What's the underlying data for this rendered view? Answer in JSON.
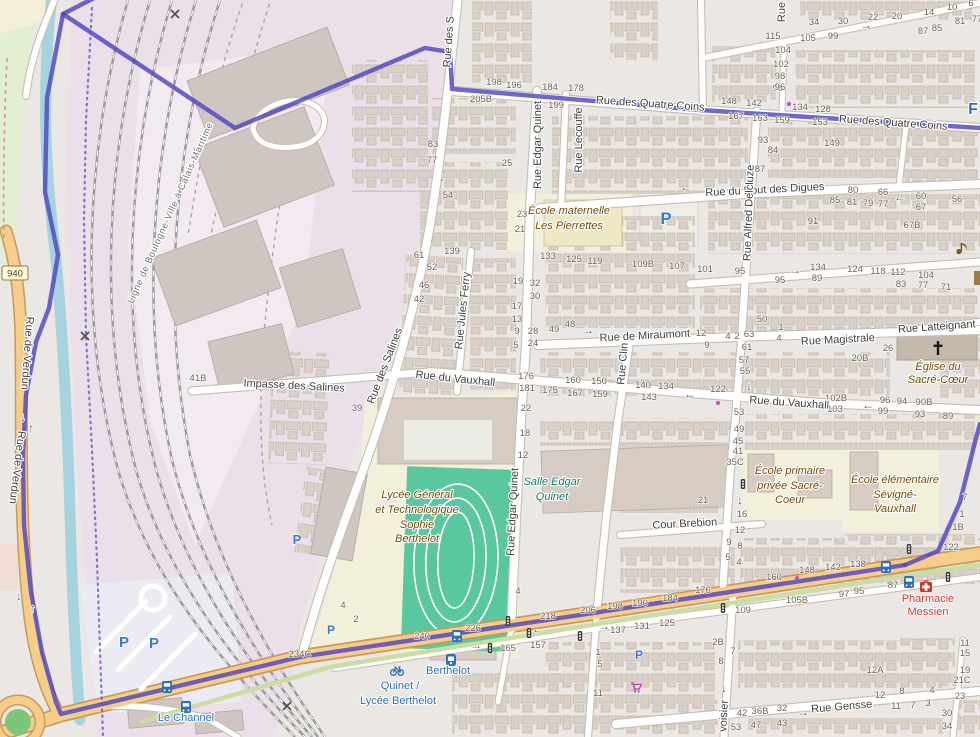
{
  "palette": {
    "boundary": "#4E46C2",
    "primary_road": "#F7CD8C",
    "railway_landuse": "#EBDFE9",
    "school": "#F2EFDA",
    "pitch_green": "#5BC79E",
    "canal": "#A6D3DD",
    "poi_brown": "#734A08",
    "leisure_teal": "#117a68",
    "health_red": "#C9362C",
    "transport_blue": "#2E6FB5",
    "parking_blue": "#3A79CA"
  },
  "badges": {
    "d940": "940"
  },
  "arrow_glyphs": {
    "left": "←",
    "right": "→",
    "up": "↑",
    "down": "↓"
  },
  "street_labels": [
    {
      "t": "Rue des Quatre Coins",
      "x": 650,
      "y": 107,
      "rot": 4
    },
    {
      "t": "Rue des Quatre Coins",
      "x": 893,
      "y": 126,
      "rot": 4
    },
    {
      "t": "Rue du Bout des Digues",
      "x": 765,
      "y": 193,
      "rot": -3
    },
    {
      "t": "Rue de Miraumont",
      "x": 645,
      "y": 339,
      "rot": -3
    },
    {
      "t": "Rue Magistrale",
      "x": 838,
      "y": 343,
      "rot": -3
    },
    {
      "t": "Rue Latteignant",
      "x": 937,
      "y": 330,
      "rot": -4
    },
    {
      "t": "Impasse des Salines",
      "x": 294,
      "y": 389,
      "rot": 3
    },
    {
      "t": "Rue du Vauxhall",
      "x": 455,
      "y": 382,
      "rot": 6
    },
    {
      "t": "Rue du Vauxhall",
      "x": 789,
      "y": 406,
      "rot": 4
    },
    {
      "t": "Cour Brebion",
      "x": 685,
      "y": 527,
      "rot": -3
    },
    {
      "t": "Rue Gensse",
      "x": 842,
      "y": 710,
      "rot": -5
    },
    {
      "t": "Rue Edgar Quinet",
      "x": 541,
      "y": 145,
      "rot": -90
    },
    {
      "t": "Rue Edgar Quinet",
      "x": 516,
      "y": 512,
      "rot": -87
    },
    {
      "t": "Rue Lecouffe",
      "x": 582,
      "y": 140,
      "rot": -90
    },
    {
      "t": "Rue Jules Ferry",
      "x": 466,
      "y": 311,
      "rot": -84
    },
    {
      "t": "Rue des Salines",
      "x": 388,
      "y": 367,
      "rot": -69
    },
    {
      "t": "Rue des S",
      "x": 452,
      "y": 42,
      "rot": -86
    },
    {
      "t": "Rue Clin",
      "x": 626,
      "y": 364,
      "rot": -85
    },
    {
      "t": "Rue Alfred Delcluze",
      "x": 752,
      "y": 213,
      "rot": -88
    },
    {
      "t": "Rue de Verdun",
      "x": 24,
      "y": 353,
      "rot": 94
    },
    {
      "t": "Rue de Verdun",
      "x": 14,
      "y": 467,
      "rot": 97
    },
    {
      "t": "voisier",
      "x": 727,
      "y": 716,
      "rot": -87
    },
    {
      "t": "Rue",
      "x": 785,
      "y": 12,
      "rot": -90
    },
    {
      "t": "Ligne de Boulogne-Ville à Calais-Maritime",
      "x": 173,
      "y": 214,
      "rot": -66,
      "cls": "rail"
    }
  ],
  "poi_labels": [
    {
      "t": "École maternelle",
      "x": 569,
      "y": 214
    },
    {
      "t": "Les Pierrettes",
      "x": 569,
      "y": 229
    },
    {
      "t": "Lycée Général",
      "x": 417,
      "y": 498
    },
    {
      "t": "et Technologique",
      "x": 417,
      "y": 513
    },
    {
      "t": "Sophie",
      "x": 417,
      "y": 528
    },
    {
      "t": "Berthelot",
      "x": 417,
      "y": 542
    },
    {
      "t": "Salle Edgar",
      "x": 552,
      "y": 485,
      "cls": "leisure"
    },
    {
      "t": "Quinet",
      "x": 552,
      "y": 500,
      "cls": "leisure"
    },
    {
      "t": "École primaire",
      "x": 790,
      "y": 474
    },
    {
      "t": "privée Sacré-",
      "x": 790,
      "y": 489
    },
    {
      "t": "Coeur",
      "x": 790,
      "y": 503
    },
    {
      "t": "École élémentaire",
      "x": 895,
      "y": 483
    },
    {
      "t": "Sévigné-",
      "x": 895,
      "y": 498
    },
    {
      "t": "Vauxhall",
      "x": 895,
      "y": 512
    },
    {
      "t": "Église du",
      "x": 938,
      "y": 370
    },
    {
      "t": "Sacré-Cœur",
      "x": 938,
      "y": 383
    },
    {
      "t": "Pharmacie",
      "x": 928,
      "y": 602,
      "cls": "health"
    },
    {
      "t": "Messien",
      "x": 928,
      "y": 615,
      "cls": "health"
    }
  ],
  "transport_labels": [
    {
      "t": "Berthelot",
      "x": 448,
      "y": 674
    },
    {
      "t": "Quinet /",
      "x": 400,
      "y": 689
    },
    {
      "t": "Lycée Berthelot",
      "x": 398,
      "y": 704
    },
    {
      "t": "Le Channel",
      "x": 186,
      "y": 721
    },
    {
      "t": "F",
      "x": 973,
      "y": 114,
      "cls": "big-blue"
    }
  ],
  "house_numbers": [
    {
      "t": "198",
      "x": 494,
      "y": 85
    },
    {
      "t": "196",
      "x": 514,
      "y": 88
    },
    {
      "t": "184",
      "x": 550,
      "y": 90
    },
    {
      "t": "178",
      "x": 576,
      "y": 91
    },
    {
      "t": "205B",
      "x": 481,
      "y": 102
    },
    {
      "t": "199",
      "x": 556,
      "y": 108
    },
    {
      "t": "96",
      "x": 778,
      "y": 91
    },
    {
      "t": "148",
      "x": 729,
      "y": 104
    },
    {
      "t": "142",
      "x": 754,
      "y": 106
    },
    {
      "t": "134",
      "x": 800,
      "y": 110
    },
    {
      "t": "128",
      "x": 823,
      "y": 112
    },
    {
      "t": "167",
      "x": 736,
      "y": 119
    },
    {
      "t": "163",
      "x": 760,
      "y": 121
    },
    {
      "t": "159",
      "x": 782,
      "y": 123
    },
    {
      "t": "153",
      "x": 820,
      "y": 125
    },
    {
      "t": "34",
      "x": 814,
      "y": 25
    },
    {
      "t": "30",
      "x": 843,
      "y": 24
    },
    {
      "t": "22",
      "x": 873,
      "y": 20
    },
    {
      "t": "20",
      "x": 897,
      "y": 19
    },
    {
      "t": "14",
      "x": 929,
      "y": 15
    },
    {
      "t": "10",
      "x": 952,
      "y": 10
    },
    {
      "t": "6",
      "x": 971,
      "y": 6
    },
    {
      "t": "115",
      "x": 773,
      "y": 39
    },
    {
      "t": "105",
      "x": 808,
      "y": 41
    },
    {
      "t": "99",
      "x": 833,
      "y": 39
    },
    {
      "t": "104",
      "x": 783,
      "y": 53
    },
    {
      "t": "102",
      "x": 781,
      "y": 67
    },
    {
      "t": "98",
      "x": 780,
      "y": 79
    },
    {
      "t": "96",
      "x": 780,
      "y": 90
    },
    {
      "t": "87",
      "x": 923,
      "y": 34
    },
    {
      "t": "85",
      "x": 937,
      "y": 31
    },
    {
      "t": "81",
      "x": 960,
      "y": 24
    },
    {
      "t": "77",
      "x": 977,
      "y": 22
    },
    {
      "t": "93",
      "x": 763,
      "y": 143
    },
    {
      "t": "84",
      "x": 773,
      "y": 153
    },
    {
      "t": "87",
      "x": 760,
      "y": 172
    },
    {
      "t": "149",
      "x": 832,
      "y": 146
    },
    {
      "t": "80",
      "x": 853,
      "y": 193
    },
    {
      "t": "66",
      "x": 883,
      "y": 195
    },
    {
      "t": "60",
      "x": 921,
      "y": 199
    },
    {
      "t": "56",
      "x": 957,
      "y": 202
    },
    {
      "t": "85",
      "x": 835,
      "y": 203
    },
    {
      "t": "81",
      "x": 852,
      "y": 205
    },
    {
      "t": "79",
      "x": 868,
      "y": 206
    },
    {
      "t": "77",
      "x": 883,
      "y": 207
    },
    {
      "t": "67",
      "x": 921,
      "y": 210
    },
    {
      "t": "91",
      "x": 813,
      "y": 224
    },
    {
      "t": "67B",
      "x": 912,
      "y": 228
    },
    {
      "t": "83",
      "x": 433,
      "y": 147
    },
    {
      "t": "77",
      "x": 432,
      "y": 163
    },
    {
      "t": "25",
      "x": 507,
      "y": 166
    },
    {
      "t": "54",
      "x": 448,
      "y": 198
    },
    {
      "t": "23",
      "x": 522,
      "y": 217
    },
    {
      "t": "21",
      "x": 520,
      "y": 232
    },
    {
      "t": "139",
      "x": 452,
      "y": 254
    },
    {
      "t": "61",
      "x": 419,
      "y": 258
    },
    {
      "t": "52",
      "x": 432,
      "y": 270
    },
    {
      "t": "46",
      "x": 424,
      "y": 288
    },
    {
      "t": "42",
      "x": 419,
      "y": 302
    },
    {
      "t": "19",
      "x": 518,
      "y": 284
    },
    {
      "t": "32",
      "x": 535,
      "y": 286
    },
    {
      "t": "30",
      "x": 535,
      "y": 299
    },
    {
      "t": "17",
      "x": 517,
      "y": 309
    },
    {
      "t": "13",
      "x": 517,
      "y": 322
    },
    {
      "t": "9",
      "x": 517,
      "y": 334
    },
    {
      "t": "5",
      "x": 516,
      "y": 348
    },
    {
      "t": "28",
      "x": 533,
      "y": 334
    },
    {
      "t": "24",
      "x": 533,
      "y": 346
    },
    {
      "t": "49",
      "x": 554,
      "y": 332
    },
    {
      "t": "48",
      "x": 570,
      "y": 327
    },
    {
      "t": "133",
      "x": 548,
      "y": 259
    },
    {
      "t": "125",
      "x": 574,
      "y": 262
    },
    {
      "t": "119",
      "x": 595,
      "y": 264
    },
    {
      "t": "109B",
      "x": 643,
      "y": 267
    },
    {
      "t": "107",
      "x": 677,
      "y": 269
    },
    {
      "t": "101",
      "x": 705,
      "y": 272
    },
    {
      "t": "95",
      "x": 740,
      "y": 274
    },
    {
      "t": "134",
      "x": 818,
      "y": 270
    },
    {
      "t": "89",
      "x": 817,
      "y": 281
    },
    {
      "t": "95",
      "x": 780,
      "y": 283
    },
    {
      "t": "124",
      "x": 855,
      "y": 272
    },
    {
      "t": "118",
      "x": 878,
      "y": 274
    },
    {
      "t": "112",
      "x": 898,
      "y": 275
    },
    {
      "t": "104",
      "x": 926,
      "y": 278
    },
    {
      "t": "83",
      "x": 901,
      "y": 287
    },
    {
      "t": "77",
      "x": 923,
      "y": 288
    },
    {
      "t": "71",
      "x": 946,
      "y": 290
    },
    {
      "t": "50",
      "x": 762,
      "y": 322
    },
    {
      "t": "1",
      "x": 781,
      "y": 330
    },
    {
      "t": "4",
      "x": 779,
      "y": 341
    },
    {
      "t": "63",
      "x": 749,
      "y": 337
    },
    {
      "t": "2",
      "x": 737,
      "y": 339
    },
    {
      "t": "4",
      "x": 728,
      "y": 339
    },
    {
      "t": "12",
      "x": 701,
      "y": 336
    },
    {
      "t": "9",
      "x": 707,
      "y": 348
    },
    {
      "t": "61",
      "x": 747,
      "y": 350
    },
    {
      "t": "26",
      "x": 888,
      "y": 351
    },
    {
      "t": "20B",
      "x": 860,
      "y": 361
    },
    {
      "t": "57",
      "x": 744,
      "y": 363
    },
    {
      "t": "55",
      "x": 745,
      "y": 374
    },
    {
      "t": "41B",
      "x": 198,
      "y": 381
    },
    {
      "t": "39",
      "x": 357,
      "y": 411
    },
    {
      "t": "176",
      "x": 526,
      "y": 379
    },
    {
      "t": "181",
      "x": 527,
      "y": 391
    },
    {
      "t": "175",
      "x": 550,
      "y": 393
    },
    {
      "t": "160",
      "x": 573,
      "y": 383
    },
    {
      "t": "167",
      "x": 575,
      "y": 396
    },
    {
      "t": "150",
      "x": 599,
      "y": 384
    },
    {
      "t": "159",
      "x": 600,
      "y": 397
    },
    {
      "t": "140",
      "x": 643,
      "y": 388
    },
    {
      "t": "134",
      "x": 666,
      "y": 389
    },
    {
      "t": "143",
      "x": 649,
      "y": 400
    },
    {
      "t": "22",
      "x": 526,
      "y": 411
    },
    {
      "t": "18",
      "x": 525,
      "y": 436
    },
    {
      "t": "122",
      "x": 718,
      "y": 392
    },
    {
      "t": "102B",
      "x": 836,
      "y": 401
    },
    {
      "t": "103",
      "x": 835,
      "y": 412
    },
    {
      "t": "96",
      "x": 885,
      "y": 403
    },
    {
      "t": "94",
      "x": 902,
      "y": 404
    },
    {
      "t": "90B",
      "x": 924,
      "y": 405
    },
    {
      "t": "99",
      "x": 883,
      "y": 414
    },
    {
      "t": "93",
      "x": 920,
      "y": 417
    },
    {
      "t": "89",
      "x": 948,
      "y": 419
    },
    {
      "t": "53",
      "x": 739,
      "y": 415
    },
    {
      "t": "49",
      "x": 739,
      "y": 432
    },
    {
      "t": "45",
      "x": 738,
      "y": 444
    },
    {
      "t": "41",
      "x": 738,
      "y": 454
    },
    {
      "t": "35C",
      "x": 735,
      "y": 465
    },
    {
      "t": "12",
      "x": 523,
      "y": 458
    },
    {
      "t": "21",
      "x": 703,
      "y": 503
    },
    {
      "t": "16",
      "x": 742,
      "y": 517
    },
    {
      "t": "12",
      "x": 740,
      "y": 533
    },
    {
      "t": "7",
      "x": 965,
      "y": 500
    },
    {
      "t": "1",
      "x": 962,
      "y": 517
    },
    {
      "t": "1B",
      "x": 958,
      "y": 530
    },
    {
      "t": "9",
      "x": 729,
      "y": 545
    },
    {
      "t": "8",
      "x": 740,
      "y": 549
    },
    {
      "t": "5",
      "x": 728,
      "y": 560
    },
    {
      "t": "4",
      "x": 739,
      "y": 565
    },
    {
      "t": "176",
      "x": 703,
      "y": 593
    },
    {
      "t": "160",
      "x": 774,
      "y": 580
    },
    {
      "t": "148",
      "x": 807,
      "y": 573
    },
    {
      "t": "142",
      "x": 833,
      "y": 570
    },
    {
      "t": "138",
      "x": 858,
      "y": 567
    },
    {
      "t": "122",
      "x": 951,
      "y": 550
    },
    {
      "t": "87",
      "x": 893,
      "y": 588
    },
    {
      "t": "97",
      "x": 844,
      "y": 597
    },
    {
      "t": "95",
      "x": 859,
      "y": 594
    },
    {
      "t": "105B",
      "x": 797,
      "y": 603
    },
    {
      "t": "109",
      "x": 743,
      "y": 613
    },
    {
      "t": "4",
      "x": 343,
      "y": 608
    },
    {
      "t": "2",
      "x": 356,
      "y": 622
    },
    {
      "t": "4",
      "x": 518,
      "y": 594
    },
    {
      "t": "240",
      "x": 422,
      "y": 639
    },
    {
      "t": "226",
      "x": 473,
      "y": 631
    },
    {
      "t": "218",
      "x": 548,
      "y": 619
    },
    {
      "t": "206",
      "x": 588,
      "y": 613
    },
    {
      "t": "198",
      "x": 615,
      "y": 609
    },
    {
      "t": "190",
      "x": 640,
      "y": 606
    },
    {
      "t": "184",
      "x": 670,
      "y": 601
    },
    {
      "t": "165",
      "x": 508,
      "y": 651
    },
    {
      "t": "157",
      "x": 538,
      "y": 648
    },
    {
      "t": "137",
      "x": 618,
      "y": 633
    },
    {
      "t": "131",
      "x": 642,
      "y": 629
    },
    {
      "t": "125",
      "x": 667,
      "y": 626
    },
    {
      "t": "1",
      "x": 598,
      "y": 655
    },
    {
      "t": "5",
      "x": 600,
      "y": 667
    },
    {
      "t": "11",
      "x": 598,
      "y": 696
    },
    {
      "t": "234C",
      "x": 300,
      "y": 657
    },
    {
      "t": "2B",
      "x": 718,
      "y": 645
    },
    {
      "t": "7",
      "x": 733,
      "y": 654
    },
    {
      "t": "8",
      "x": 721,
      "y": 664
    },
    {
      "t": "12A",
      "x": 875,
      "y": 673
    },
    {
      "t": "12",
      "x": 880,
      "y": 698
    },
    {
      "t": "8",
      "x": 902,
      "y": 694
    },
    {
      "t": "4",
      "x": 932,
      "y": 693
    },
    {
      "t": "11",
      "x": 896,
      "y": 709
    },
    {
      "t": "7",
      "x": 913,
      "y": 708
    },
    {
      "t": "3",
      "x": 928,
      "y": 706
    },
    {
      "t": "23",
      "x": 960,
      "y": 699
    },
    {
      "t": "30",
      "x": 947,
      "y": 716
    },
    {
      "t": "34",
      "x": 947,
      "y": 729
    },
    {
      "t": "11",
      "x": 965,
      "y": 646
    },
    {
      "t": "15",
      "x": 965,
      "y": 656
    },
    {
      "t": "19",
      "x": 965,
      "y": 673
    },
    {
      "t": "21C",
      "x": 962,
      "y": 683
    },
    {
      "t": "42",
      "x": 742,
      "y": 716
    },
    {
      "t": "36B",
      "x": 760,
      "y": 714
    },
    {
      "t": "32",
      "x": 782,
      "y": 711
    },
    {
      "t": "43",
      "x": 782,
      "y": 726
    },
    {
      "t": "47",
      "x": 756,
      "y": 728
    },
    {
      "t": "53",
      "x": 736,
      "y": 730
    }
  ],
  "arrows": [
    {
      "dir": "left",
      "x": 686,
      "y": 191
    },
    {
      "dir": "left",
      "x": 900,
      "y": 201
    },
    {
      "dir": "right",
      "x": 866,
      "y": 29
    },
    {
      "dir": "down",
      "x": 442,
      "y": 181
    },
    {
      "dir": "right",
      "x": 588,
      "y": 334
    },
    {
      "dir": "right",
      "x": 795,
      "y": 274
    },
    {
      "dir": "left",
      "x": 868,
      "y": 409
    },
    {
      "dir": "left",
      "x": 690,
      "y": 398
    },
    {
      "dir": "down",
      "x": 749,
      "y": 390
    },
    {
      "dir": "down",
      "x": 740,
      "y": 504
    },
    {
      "dir": "down",
      "x": 724,
      "y": 692
    },
    {
      "dir": "right",
      "x": 803,
      "y": 716
    },
    {
      "dir": "left",
      "x": 538,
      "y": 633
    },
    {
      "dir": "right",
      "x": 604,
      "y": 630
    },
    {
      "dir": "right",
      "x": 476,
      "y": 649
    },
    {
      "dir": "down",
      "x": 19,
      "y": 600
    },
    {
      "dir": "up",
      "x": 33,
      "y": 612
    },
    {
      "dir": "down",
      "x": 23,
      "y": 421
    },
    {
      "dir": "up",
      "x": 31,
      "y": 432
    }
  ],
  "icons": [
    {
      "type": "parking",
      "x": 666,
      "y": 224,
      "s": 17,
      "glyph": "P"
    },
    {
      "type": "parking",
      "x": 124,
      "y": 647,
      "s": 15,
      "glyph": "P"
    },
    {
      "type": "parking",
      "x": 154,
      "y": 648,
      "s": 15,
      "glyph": "P"
    },
    {
      "type": "parking",
      "x": 297,
      "y": 544,
      "s": 13,
      "glyph": "P"
    },
    {
      "type": "parking",
      "x": 331,
      "y": 634,
      "s": 12,
      "glyph": "P"
    },
    {
      "type": "parking",
      "x": 639,
      "y": 659,
      "s": 12,
      "glyph": "P"
    },
    {
      "type": "bus",
      "x": 457,
      "y": 636
    },
    {
      "type": "bus",
      "x": 886,
      "y": 567
    },
    {
      "type": "bus",
      "x": 909,
      "y": 582
    },
    {
      "type": "bus",
      "x": 167,
      "y": 687
    },
    {
      "type": "bus",
      "x": 186,
      "y": 707
    },
    {
      "type": "train",
      "x": 451,
      "y": 660
    },
    {
      "type": "bike",
      "x": 397,
      "y": 670
    },
    {
      "type": "signal",
      "x": 743,
      "y": 484
    },
    {
      "type": "signal",
      "x": 909,
      "y": 549
    },
    {
      "type": "signal",
      "x": 948,
      "y": 577
    },
    {
      "type": "signal",
      "x": 508,
      "y": 621
    },
    {
      "type": "signal",
      "x": 529,
      "y": 633
    },
    {
      "type": "signal",
      "x": 580,
      "y": 636
    },
    {
      "type": "signal",
      "x": 490,
      "y": 648
    },
    {
      "type": "signal",
      "x": 723,
      "y": 608
    },
    {
      "type": "cross",
      "x": 175,
      "y": 14
    },
    {
      "type": "cross",
      "x": 85,
      "y": 336
    },
    {
      "type": "cross",
      "x": 287,
      "y": 706
    },
    {
      "type": "cart",
      "x": 636,
      "y": 687
    },
    {
      "type": "aid",
      "x": 926,
      "y": 586
    },
    {
      "type": "churchcross",
      "x": 938,
      "y": 348
    },
    {
      "type": "music",
      "x": 961,
      "y": 248
    },
    {
      "type": "poibar",
      "x": 977,
      "y": 278
    },
    {
      "type": "dot",
      "x": 789,
      "y": 104
    },
    {
      "type": "dot",
      "x": 718,
      "y": 403
    },
    {
      "type": "dot",
      "x": 797,
      "y": 578
    }
  ]
}
